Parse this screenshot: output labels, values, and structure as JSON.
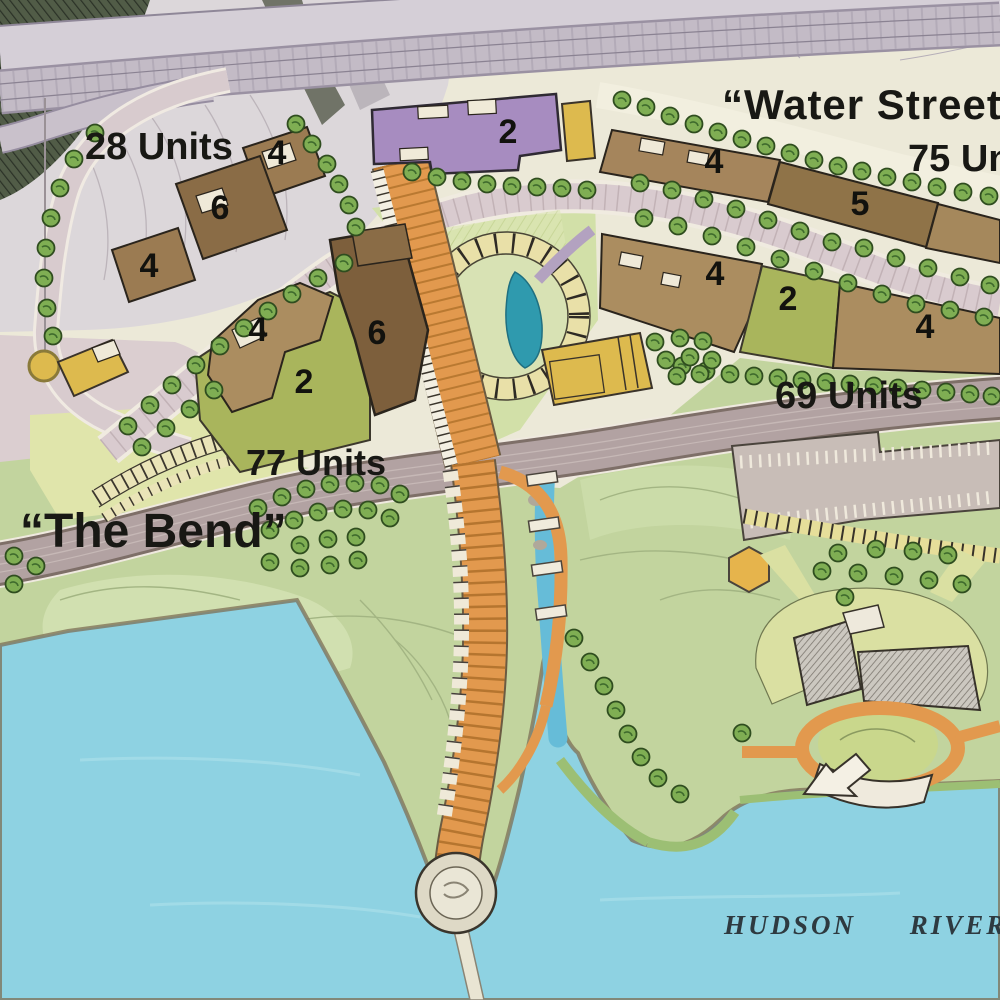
{
  "labels": {
    "water_street": "“Water Street”",
    "units_28": "28 Units",
    "units_75": "75 Units",
    "units_69": "69 Units",
    "units_77": "77 Units",
    "the_bend": "“The Bend”",
    "hudson_river": "HUDSON RIVER"
  },
  "building_numbers": {
    "nw_top": "4",
    "nw_mid": "6",
    "nw_low": "4",
    "purple": "2",
    "block_tan": "4",
    "block_brown": "6",
    "block_green": "2",
    "row1_west": "4",
    "row1_east": "5",
    "row2_west": "4",
    "row2_mid": "2",
    "row2_east": "4"
  },
  "map_colors": {
    "water": "#8ed2e2",
    "park_green": "#c2d49e",
    "road_mauve": "#b2a2a2",
    "path_orange": "#e2994e",
    "building_brown": "#8f7348",
    "building_tan": "#ab8d60",
    "building_purple": "#a78cc0",
    "building_gold": "#ddba4e",
    "parcel_olive": "#a9b55c",
    "tree_green": "#7fae53"
  }
}
